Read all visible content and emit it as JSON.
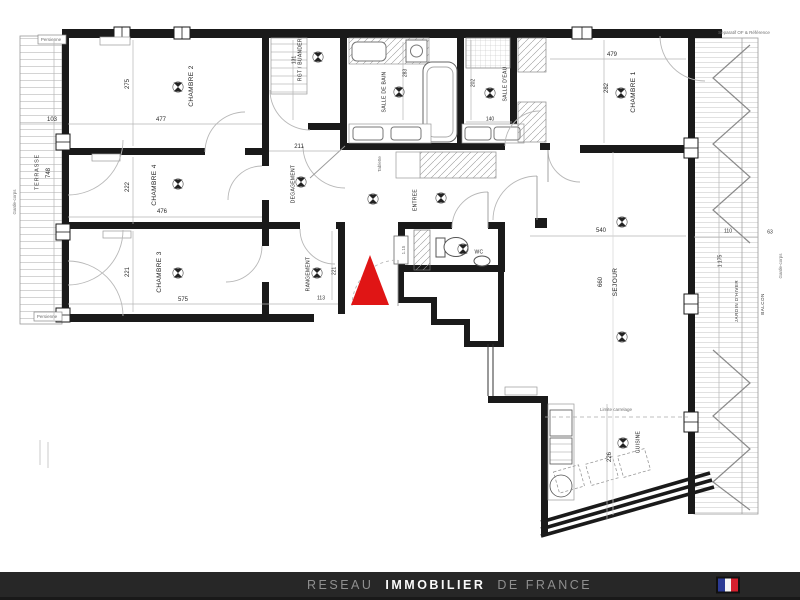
{
  "plan": {
    "marker_color": "#e01515",
    "wall_color": "#1a1a1a",
    "labels": [
      {
        "t": "CHAMBRE 2",
        "x": 192,
        "y": 86,
        "v": true,
        "c": "room"
      },
      {
        "t": "CHAMBRE 4",
        "x": 155,
        "y": 185,
        "v": true,
        "c": "room"
      },
      {
        "t": "CHAMBRE 3",
        "x": 160,
        "y": 272,
        "v": true,
        "c": "room"
      },
      {
        "t": "CHAMBRE 1",
        "x": 634,
        "y": 92,
        "v": true,
        "c": "room"
      },
      {
        "t": "RGT / BUANDERIE",
        "x": 301,
        "y": 57,
        "v": true,
        "c": "room-sm"
      },
      {
        "t": "SALLE DE BAIN",
        "x": 385,
        "y": 92,
        "v": true,
        "c": "room-sm"
      },
      {
        "t": "SALLE D'EAU",
        "x": 506,
        "y": 84,
        "v": true,
        "c": "room-sm"
      },
      {
        "t": "DEGAGEMENT",
        "x": 294,
        "y": 184,
        "v": true,
        "c": "room-sm"
      },
      {
        "t": "ENTREE",
        "x": 416,
        "y": 200,
        "v": true,
        "c": "room-sm"
      },
      {
        "t": "RANGEMENT",
        "x": 309,
        "y": 274,
        "v": true,
        "c": "room-sm"
      },
      {
        "t": "WC",
        "x": 479,
        "y": 253,
        "v": false,
        "c": "room-sm"
      },
      {
        "t": "SEJOUR",
        "x": 616,
        "y": 282,
        "v": true,
        "c": "room"
      },
      {
        "t": "CUISINE",
        "x": 639,
        "y": 442,
        "v": true,
        "c": "room-sm"
      },
      {
        "t": "103",
        "x": 52,
        "y": 120,
        "v": false,
        "c": "dim"
      },
      {
        "t": "477",
        "x": 161,
        "y": 120,
        "v": false,
        "c": "dim"
      },
      {
        "t": "275",
        "x": 128,
        "y": 84,
        "v": true,
        "c": "dim"
      },
      {
        "t": "748",
        "x": 49,
        "y": 173,
        "v": true,
        "c": "dim"
      },
      {
        "t": "222",
        "x": 128,
        "y": 187,
        "v": true,
        "c": "dim"
      },
      {
        "t": "476",
        "x": 162,
        "y": 212,
        "v": false,
        "c": "dim"
      },
      {
        "t": "221",
        "x": 128,
        "y": 272,
        "v": true,
        "c": "dim"
      },
      {
        "t": "575",
        "x": 183,
        "y": 300,
        "v": false,
        "c": "dim"
      },
      {
        "t": "211",
        "x": 299,
        "y": 147,
        "v": false,
        "c": "dim"
      },
      {
        "t": "131",
        "x": 295,
        "y": 60,
        "v": true,
        "c": "dim-sm"
      },
      {
        "t": "283",
        "x": 406,
        "y": 73,
        "v": true,
        "c": "dim-sm"
      },
      {
        "t": "202",
        "x": 474,
        "y": 83,
        "v": true,
        "c": "dim-sm"
      },
      {
        "t": "140",
        "x": 490,
        "y": 120,
        "v": false,
        "c": "dim-sm"
      },
      {
        "t": "479",
        "x": 612,
        "y": 55,
        "v": false,
        "c": "dim"
      },
      {
        "t": "282",
        "x": 607,
        "y": 88,
        "v": true,
        "c": "dim"
      },
      {
        "t": "540",
        "x": 601,
        "y": 231,
        "v": false,
        "c": "dim"
      },
      {
        "t": "660",
        "x": 601,
        "y": 282,
        "v": true,
        "c": "dim"
      },
      {
        "t": "221",
        "x": 335,
        "y": 271,
        "v": true,
        "c": "dim-sm"
      },
      {
        "t": "113",
        "x": 321,
        "y": 299,
        "v": false,
        "c": "dim-sm"
      },
      {
        "t": "226",
        "x": 610,
        "y": 457,
        "v": true,
        "c": "dim"
      },
      {
        "t": "110",
        "x": 728,
        "y": 232,
        "v": false,
        "c": "dim-sm"
      },
      {
        "t": "63",
        "x": 770,
        "y": 233,
        "v": false,
        "c": "dim-sm"
      },
      {
        "t": "1 175",
        "x": 721,
        "y": 261,
        "v": true,
        "c": "dim-sm"
      },
      {
        "t": "TERRASSE",
        "x": 38,
        "y": 172,
        "v": true,
        "c": "side"
      },
      {
        "t": "JARDIN D'HIVER",
        "x": 737,
        "y": 301,
        "v": true,
        "c": "side-sm"
      },
      {
        "t": "BALCON",
        "x": 763,
        "y": 304,
        "v": true,
        "c": "side-sm"
      },
      {
        "t": "Garde-corps",
        "x": 15,
        "y": 202,
        "v": true,
        "c": "tiny"
      },
      {
        "t": "Garde-corps",
        "x": 781,
        "y": 266,
        "v": true,
        "c": "tiny"
      },
      {
        "t": "Persienne",
        "x": 51,
        "y": 40,
        "v": false,
        "c": "tiny"
      },
      {
        "t": "Persienne",
        "x": 47,
        "y": 317,
        "v": false,
        "c": "tiny"
      },
      {
        "t": "Séparatif OF & Référence",
        "x": 744,
        "y": 33,
        "v": false,
        "c": "tiny"
      },
      {
        "t": "Limite carrelage",
        "x": 616,
        "y": 410,
        "v": false,
        "c": "tiny"
      },
      {
        "t": "Tablette",
        "x": 380,
        "y": 164,
        "v": true,
        "c": "tiny"
      },
      {
        "t": "1.15",
        "x": 404,
        "y": 250,
        "v": true,
        "c": "tiny"
      }
    ]
  },
  "footer": {
    "brand": {
      "prefix": "RESEAU",
      "main": "IMMOBILIER",
      "suffix": "DE FRANCE"
    },
    "bar_color": "#272727",
    "flag": {
      "blue": "#2b3a94",
      "white": "#f5f5f5",
      "red": "#d6202e"
    }
  }
}
